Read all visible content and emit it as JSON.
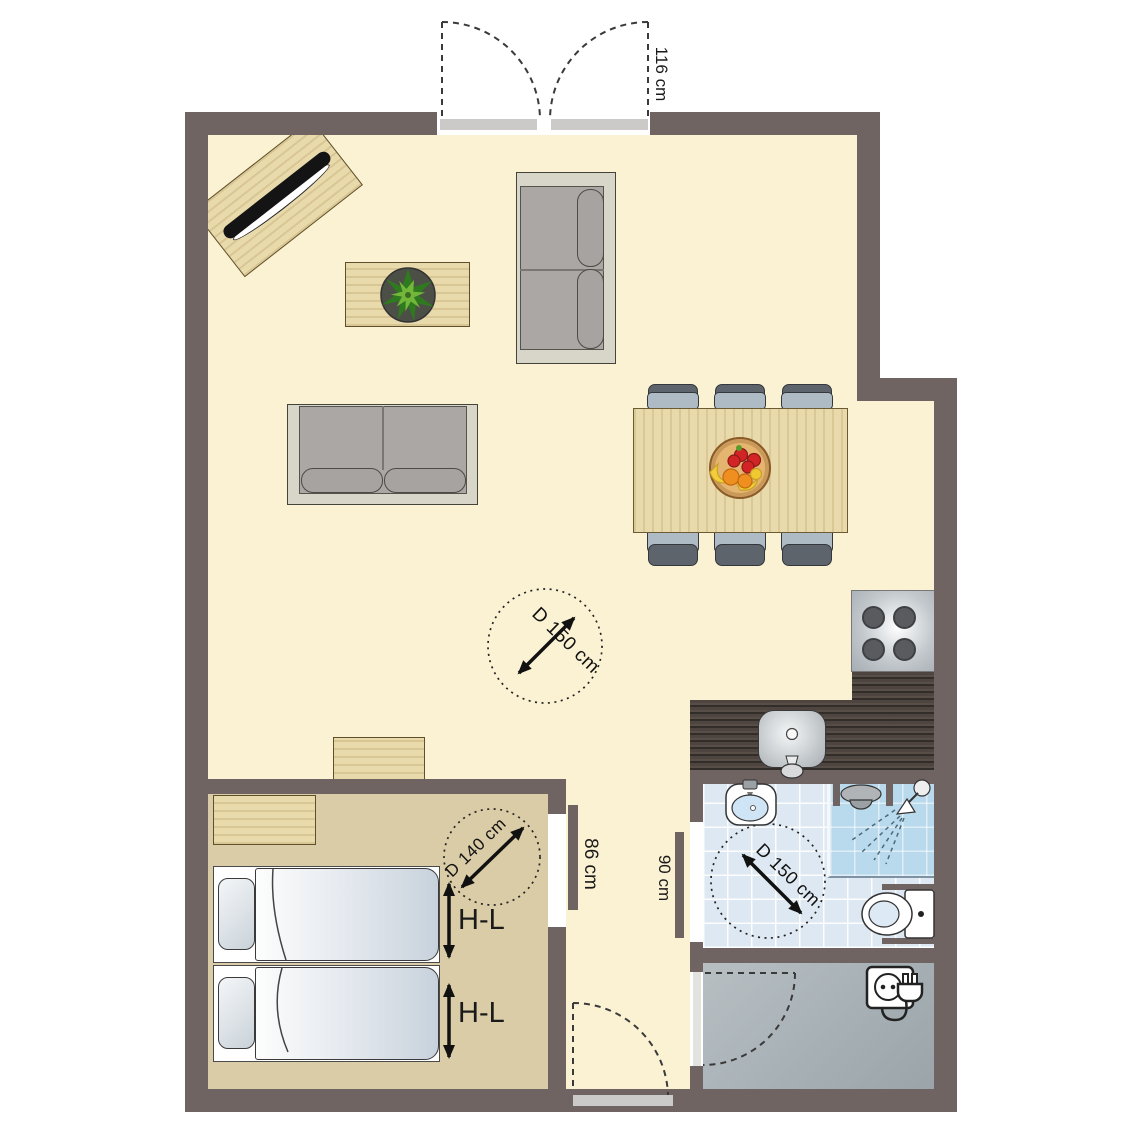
{
  "plan": {
    "entry_door_width": "116 cm",
    "bedroom_door_width": "86 cm",
    "bathroom_door_width": "90 cm",
    "living_turning_circle": "D 150 cm",
    "bedroom_turning_circle": "D 140 cm",
    "bathroom_turning_circle": "D 150 cm",
    "bed1_label": "H-L",
    "bed2_label": "H-L"
  },
  "colors": {
    "wall": "#6F6461",
    "living_floor": "#FBF2D4",
    "bedroom_floor": "#D9CCA6",
    "bathroom_floor": "#DDE8F2",
    "shower_floor": "#B9D9EC",
    "storage_floor": "#AAB3B7",
    "kitchen_counter": "#4E4540",
    "wood_furniture": "#E9DAAC",
    "door_leaf": "#CBCAC8",
    "sofa_frame": "#D7D6C9",
    "sofa_seat": "#ABA7A4",
    "chair_seat": "#AEBAC4",
    "chair_back": "#5E646B",
    "mattress": "#DDE3EA",
    "annotation_text": "#1A1A1A"
  }
}
